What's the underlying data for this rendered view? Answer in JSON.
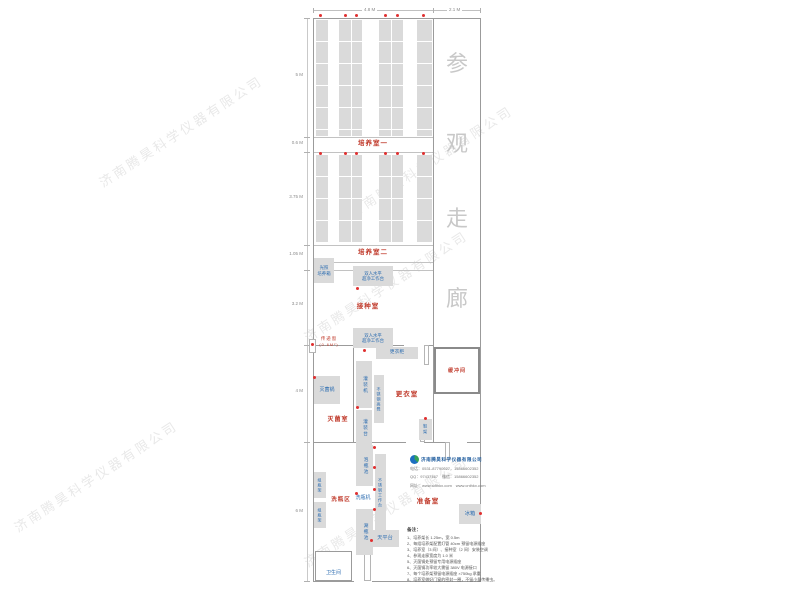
{
  "dimensions": {
    "top": [
      "4.8 M",
      "2.1 M"
    ],
    "left": [
      "5 M",
      "0.6 M",
      "3.75 M",
      "1.05 M",
      "3.2 M",
      "4 M",
      "6 M"
    ]
  },
  "corridor": {
    "chars": [
      "参",
      "观",
      "走",
      "廊"
    ]
  },
  "rooms": {
    "culture1": "培养室一",
    "culture2": "培养室二",
    "inoculation": "接种室",
    "transfer_window": "传递窗",
    "transfer_window_size": "(0.6M²)",
    "buffer": "缓冲间",
    "sterilization": "灭菌室",
    "changing": "更衣室",
    "washing_area": "洗瓶区",
    "preparation": "准备室"
  },
  "equipment": {
    "light_incubator": "光照\n培养箱",
    "clean_bench": "双人水平\n超净工作台",
    "wardrobe": "更衣柜",
    "filling_machine": "灌装机",
    "steel_stool": "不锈钢高凳",
    "sterilizer": "灭菌锅",
    "filling_table": "灌装台",
    "shoe_rack": "鞋架",
    "soak_pool": "泡瓶池",
    "steel_worktable": "不锈钢工作台",
    "bottle_washer": "洗瓶机",
    "bottle_rack": "组瓶架",
    "rinse_pool": "涮瓶池",
    "balance_table": "天平台",
    "fridge": "冰箱",
    "toilet": "卫生间"
  },
  "company": {
    "name": "济南腾昊科学仪器有限公司",
    "phone": "电话：0531-87790627，15866602352",
    "qq": "QQ：97437467　微信：15866602352",
    "web": "网址：www.sdthkx.com　www.cnthkx.com"
  },
  "notes": {
    "title": "备注：",
    "items": [
      "1、培养架长 1.25m，宽 0.5m",
      "2、每组培养架配置灯管 40cm 预留电源插座",
      "3、培养室（3 间）、接种室（2 间）安装空调",
      "4、参观走廊宽度为 1.0 米",
      "5、灭菌锅处预留专用电源插座",
      "6、灭菌锅功率较大需留 380V 电源接口",
      "7、每个培养架预留电源插座 ×750kg 承重",
      "8、培养室做好门窗的密封一圈，不留小量传播虫。"
    ]
  },
  "watermark": "济南腾昊科学仪器有限公司",
  "colors": {
    "room_label": "#c03a2b",
    "equipment_label": "#2b6cb0",
    "rack_fill": "#dadada",
    "wall": "#9b9b9b",
    "corridor_text": "#c8c8c8",
    "outlet_dot": "#e03030"
  }
}
